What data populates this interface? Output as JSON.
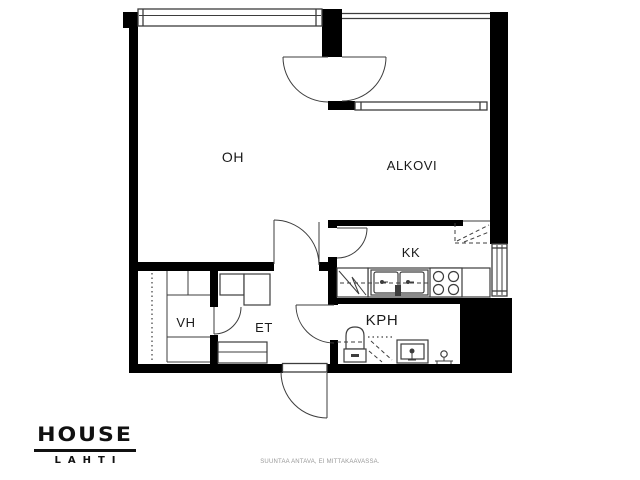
{
  "rooms": {
    "oh": {
      "label": "OH"
    },
    "alkovi": {
      "label": "ALKOVI"
    },
    "kk": {
      "label": "KK"
    },
    "vh": {
      "label": "VH"
    },
    "et": {
      "label": "ET"
    },
    "kph": {
      "label": "KPH"
    }
  },
  "branding": {
    "logo_primary": "HOUSE",
    "logo_secondary": "LAHTI"
  },
  "footer": {
    "disclaimer": "SUUNTAA ANTAVA, EI MITTAKAAVASSA."
  },
  "colors": {
    "wall": "#000000",
    "line": "#3d3d3d",
    "background": "#ffffff",
    "text": "#1a1a1a"
  },
  "fixtures": [
    "fridge",
    "kitchen-sink",
    "stove",
    "upper-cabinet",
    "toilet",
    "shower",
    "washbasin",
    "washing-machine-valve",
    "wardrobe",
    "coat-rail",
    "hall-closet",
    "shoe-cabinet"
  ]
}
